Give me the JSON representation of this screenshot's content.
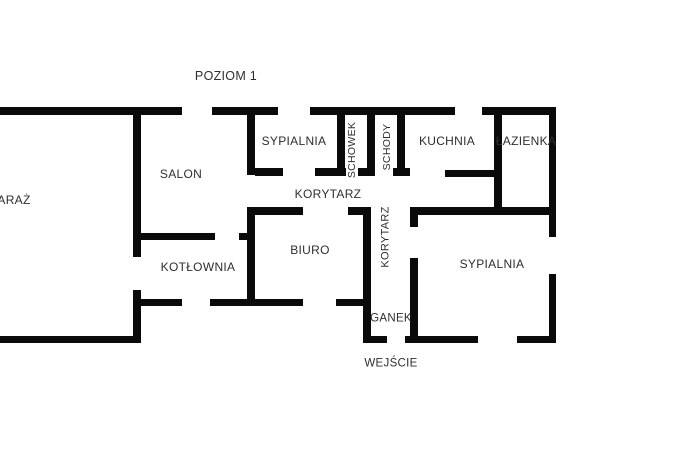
{
  "title": "POZIOM 1",
  "plan": {
    "width": 699,
    "height": 470,
    "background_color": "#ffffff",
    "wall_color": "#0a0a0a",
    "text_color": "#2e2e2e"
  },
  "labels": [
    {
      "id": "level-title",
      "text": "POZIOM 1",
      "cx": 226,
      "cy": 76,
      "size": 12.5,
      "rotate": 0
    },
    {
      "id": "garaz",
      "text": "ARAŻ",
      "cx": 14,
      "cy": 200,
      "size": 12,
      "rotate": 0
    },
    {
      "id": "salon",
      "text": "SALON",
      "cx": 181,
      "cy": 174,
      "size": 12,
      "rotate": 0
    },
    {
      "id": "sypialnia-gorna",
      "text": "SYPIALNIA",
      "cx": 294,
      "cy": 141,
      "size": 12,
      "rotate": 0
    },
    {
      "id": "schowek",
      "text": "SCHOWEK",
      "cx": 352,
      "cy": 150,
      "size": 10.5,
      "rotate": -90
    },
    {
      "id": "schody",
      "text": "SCHODY",
      "cx": 387,
      "cy": 147,
      "size": 10.5,
      "rotate": -90
    },
    {
      "id": "kuchnia",
      "text": "KUCHNIA",
      "cx": 447,
      "cy": 141,
      "size": 12,
      "rotate": 0
    },
    {
      "id": "lazienka",
      "text": "ŁAZIENKA",
      "cx": 526,
      "cy": 141,
      "size": 12,
      "rotate": 0
    },
    {
      "id": "korytarz-poziomy",
      "text": "KORYTARZ",
      "cx": 328,
      "cy": 194,
      "size": 12,
      "rotate": 0
    },
    {
      "id": "korytarz-pionowy",
      "text": "KORYTARZ",
      "cx": 386,
      "cy": 237,
      "size": 11,
      "rotate": -90
    },
    {
      "id": "kotlownia",
      "text": "KOTŁOWNIA",
      "cx": 198,
      "cy": 267,
      "size": 12,
      "rotate": 0
    },
    {
      "id": "biuro",
      "text": "BIURO",
      "cx": 310,
      "cy": 250,
      "size": 12,
      "rotate": 0
    },
    {
      "id": "sypialnia-dolna",
      "text": "SYPIALNIA",
      "cx": 492,
      "cy": 264,
      "size": 12,
      "rotate": 0
    },
    {
      "id": "ganek",
      "text": "GANEK",
      "cx": 391,
      "cy": 319,
      "size": 11.5,
      "rotate": 0
    },
    {
      "id": "wejscie",
      "text": "WEJŚCIE",
      "cx": 391,
      "cy": 364,
      "size": 11.5,
      "rotate": 0
    }
  ],
  "walls": [
    {
      "x": 0,
      "y": 107,
      "w": 182,
      "h": 8
    },
    {
      "x": 212,
      "y": 107,
      "w": 66,
      "h": 8
    },
    {
      "x": 310,
      "y": 107,
      "w": 145,
      "h": 8
    },
    {
      "x": 482,
      "y": 107,
      "w": 74,
      "h": 8
    },
    {
      "x": 549,
      "y": 107,
      "w": 7,
      "h": 130
    },
    {
      "x": 549,
      "y": 274,
      "w": 7,
      "h": 69
    },
    {
      "x": 405,
      "y": 336,
      "w": 73,
      "h": 7
    },
    {
      "x": 517,
      "y": 336,
      "w": 39,
      "h": 7
    },
    {
      "x": 0,
      "y": 336,
      "w": 140,
      "h": 7
    },
    {
      "x": 133,
      "y": 107,
      "w": 8,
      "h": 150
    },
    {
      "x": 133,
      "y": 290,
      "w": 8,
      "h": 53
    },
    {
      "x": 247,
      "y": 115,
      "w": 8,
      "h": 60
    },
    {
      "x": 255,
      "y": 168,
      "w": 28,
      "h": 8
    },
    {
      "x": 315,
      "y": 168,
      "w": 31,
      "h": 8
    },
    {
      "x": 358,
      "y": 168,
      "w": 17,
      "h": 8
    },
    {
      "x": 393,
      "y": 168,
      "w": 17,
      "h": 8
    },
    {
      "x": 445,
      "y": 170,
      "w": 49,
      "h": 7
    },
    {
      "x": 337,
      "y": 115,
      "w": 8,
      "h": 61
    },
    {
      "x": 367,
      "y": 115,
      "w": 8,
      "h": 61
    },
    {
      "x": 397,
      "y": 115,
      "w": 8,
      "h": 61
    },
    {
      "x": 494,
      "y": 107,
      "w": 8,
      "h": 108
    },
    {
      "x": 410,
      "y": 207,
      "w": 146,
      "h": 8
    },
    {
      "x": 247,
      "y": 207,
      "w": 56,
      "h": 8
    },
    {
      "x": 348,
      "y": 207,
      "w": 23,
      "h": 8
    },
    {
      "x": 247,
      "y": 207,
      "w": 8,
      "h": 99
    },
    {
      "x": 135,
      "y": 233,
      "w": 80,
      "h": 7
    },
    {
      "x": 239,
      "y": 233,
      "w": 8,
      "h": 7
    },
    {
      "x": 135,
      "y": 299,
      "w": 47,
      "h": 7
    },
    {
      "x": 210,
      "y": 299,
      "w": 93,
      "h": 7
    },
    {
      "x": 336,
      "y": 299,
      "w": 35,
      "h": 7
    },
    {
      "x": 363,
      "y": 207,
      "w": 8,
      "h": 136
    },
    {
      "x": 363,
      "y": 336,
      "w": 24,
      "h": 7
    },
    {
      "x": 410,
      "y": 215,
      "w": 8,
      "h": 12
    },
    {
      "x": 410,
      "y": 258,
      "w": 8,
      "h": 85
    }
  ]
}
